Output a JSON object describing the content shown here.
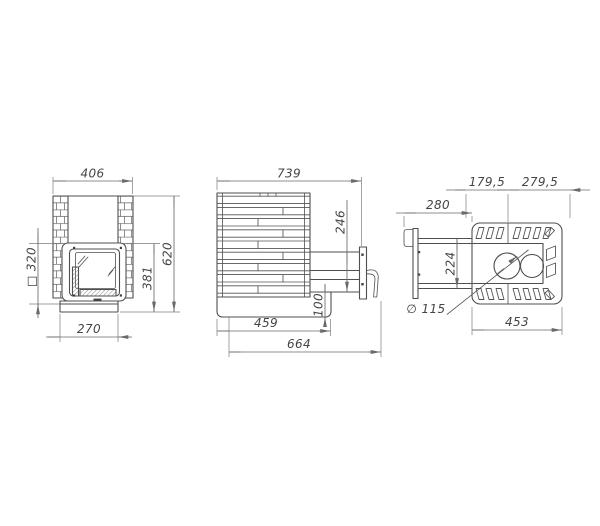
{
  "title": "stove-three-view-technical-drawing",
  "colors": {
    "line": "#4f4f4f",
    "dimension": "#6a6a6a",
    "text": "#454545",
    "background": "#ffffff"
  },
  "views": {
    "front": {
      "top_width": "406",
      "firebox": "□ 320",
      "body_height": "381",
      "total_height": "620",
      "base_width": "270"
    },
    "side": {
      "total_depth": "739",
      "tunnel_height": "246",
      "bottom_offset": "100",
      "body_depth": "459",
      "overall_depth": "664"
    },
    "top": {
      "flue_left": "179,5",
      "flue_right": "279,5",
      "tunnel_extension": "280",
      "tunnel_width": "224",
      "flue_diameter": "∅ 115",
      "body_width": "453"
    }
  }
}
